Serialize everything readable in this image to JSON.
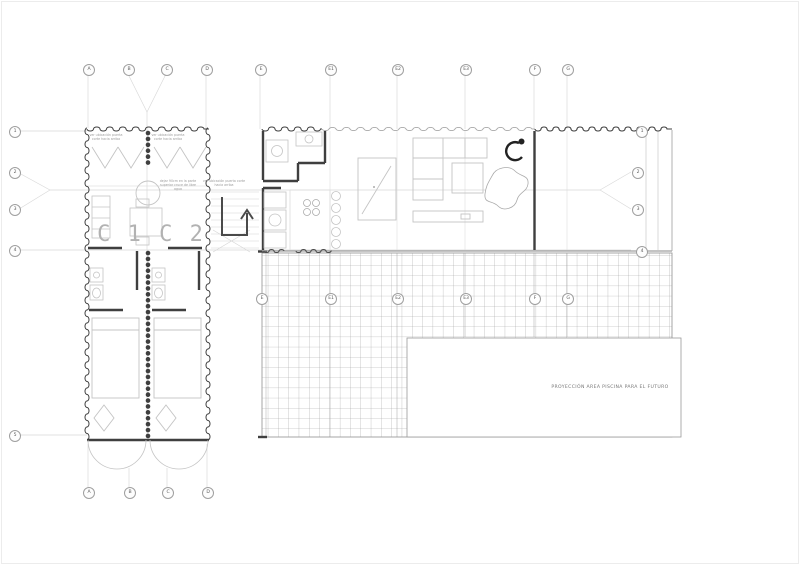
{
  "grid": {
    "top_labels": [
      "A",
      "B",
      "C",
      "D",
      "E",
      "E1",
      "E2",
      "E3",
      "F",
      "G"
    ],
    "bottom_labels": [
      "A",
      "B",
      "C",
      "D"
    ],
    "left_labels": [
      "1",
      "2",
      "3",
      "4",
      "5"
    ],
    "right_labels": [
      "1",
      "2",
      "3",
      "4"
    ],
    "deck_labels": [
      "E",
      "E1",
      "E2",
      "E3",
      "F",
      "G"
    ]
  },
  "units": {
    "c1": "C 1",
    "c2": "C 2"
  },
  "pool": {
    "label": "PROYECCIÓN AREA PISCINA PARA EL  FUTURO"
  },
  "annotations": {
    "c1_top": "ver ubicación puerta corte hacia arriba",
    "c2_top": "ver ubicación puerta corte hacia arriba",
    "center": "dejar 90cm en la parte superior cruce de libre agua",
    "stairs": "ver ubicación puerta corte hacia arriba"
  },
  "colors": {
    "wall": "#3f3f3f",
    "light_line": "#c4c4c4",
    "deck_grid": "#9d9d9d",
    "marker": "#9f9f9f"
  }
}
